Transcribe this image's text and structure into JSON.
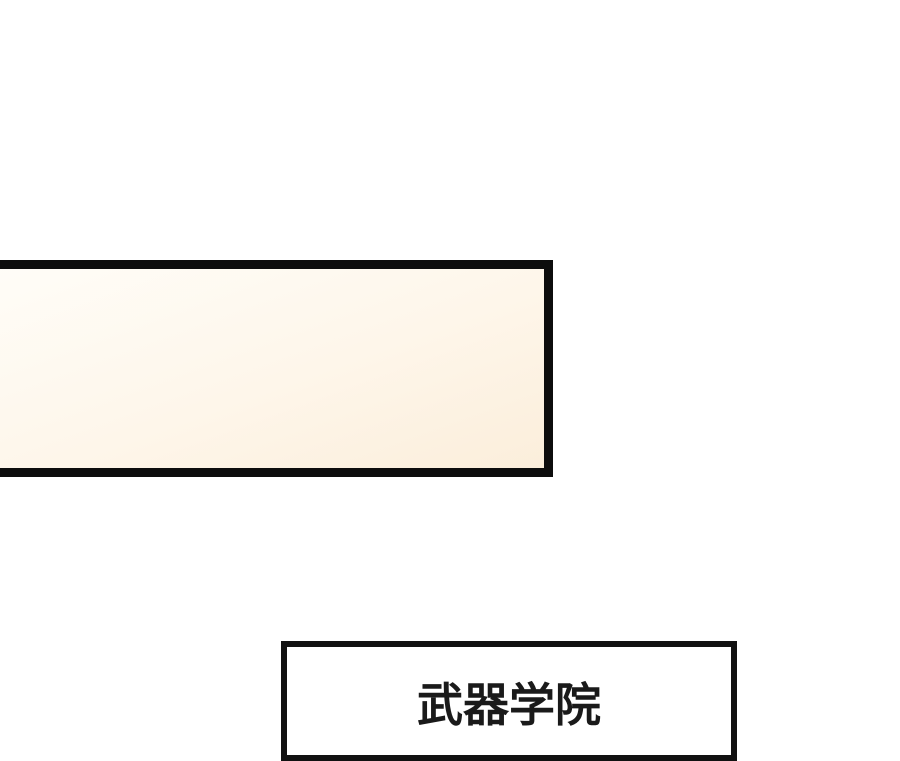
{
  "page": {
    "background_color": "#ffffff",
    "type": "comic-panel-strip"
  },
  "caption_box": {
    "text": "",
    "border_color": "#0d0d0d",
    "fill_top_color": "#fffdf8",
    "fill_bottom_color": "#fbeedb"
  },
  "label_box": {
    "text": "武器学院",
    "border_color": "#111111",
    "fill_color": "#ffffff",
    "text_color": "#1a1a1a"
  }
}
